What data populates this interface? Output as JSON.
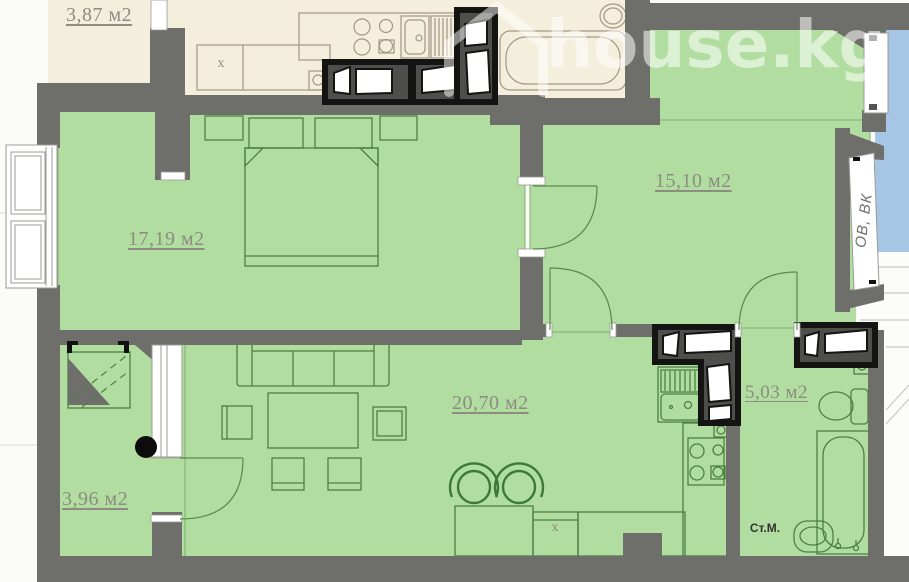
{
  "watermark": {
    "text": "house.kg"
  },
  "rooms": {
    "hall": {
      "label": "3,87 м2"
    },
    "bedroom": {
      "label": "17,19 м2"
    },
    "room2": {
      "label": "15,10 м2"
    },
    "living": {
      "label": "20,70 м2"
    },
    "bathroom": {
      "label": "5,03 м2"
    },
    "balcony": {
      "label": "3,96 м2"
    }
  },
  "annotations": {
    "shaft": "ОВ, ВК",
    "washing_machine": "Ст.М.",
    "marker_kitchen": "x",
    "marker_laundry": "x"
  },
  "colors": {
    "room_green": "#b2dda1",
    "adjacent_beige": "#f4eedd",
    "neighbor_blue": "#a7c6e5",
    "wall_gray": "#6e6e6a",
    "label_gray": "#8c8c81"
  }
}
